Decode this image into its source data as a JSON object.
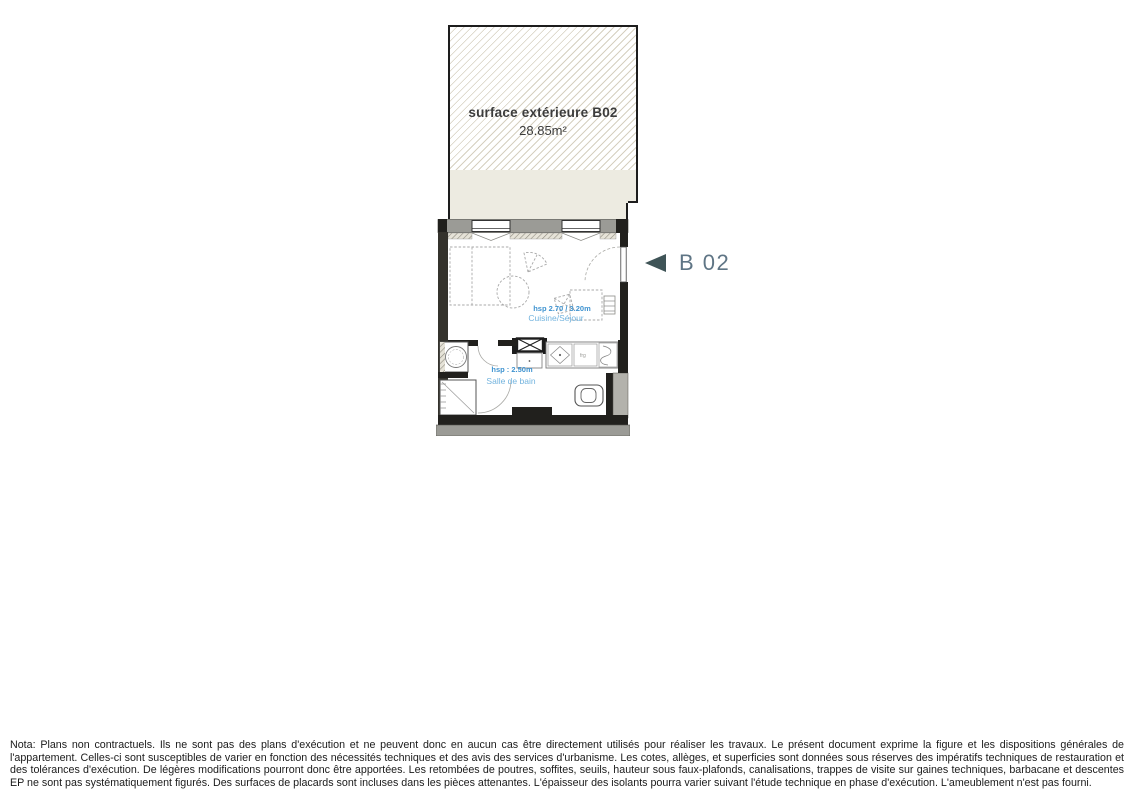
{
  "terrace": {
    "title": "surface extérieure B02",
    "area": "28.85m²"
  },
  "marker": {
    "label": "B 02"
  },
  "plan": {
    "rooms": [
      {
        "name": "Cuisine/Séjour",
        "ceiling_note": "hsp 2.70 / 3.20m"
      },
      {
        "name": "Salle de bain",
        "ceiling_note": "hsp : 2.50m"
      }
    ],
    "fridge_label": "frg"
  },
  "colors": {
    "room_label_blue": "#72b3de",
    "ceiling_note_blue": "#3f93d0",
    "marker_text": "#5f7585",
    "marker_arrow": "#3f5457",
    "terrace_floor_beige": "#edebe1",
    "hatch_line": "#d6d0c0",
    "wall_dark": "#21201d",
    "wall_gray": "#9b9b96"
  },
  "nota": {
    "text": "Nota: Plans non contractuels. Ils ne sont pas des plans d'exécution et ne peuvent donc en aucun cas être directement utilisés pour réaliser les travaux. Le présent document exprime la figure et les dispositions générales de l'appartement. Celles-ci sont susceptibles de varier en fonction des nécessités techniques et des avis des services d'urbanisme. Les cotes, allèges, et superficies sont données sous réserves des impératifs techniques de restauration et des tolérances d'exécution. De légères modifications pourront donc être apportées. Les retombées de poutres, soffites, seuils,  hauteur sous faux-plafonds, canalisations, trappes de visite sur gaines techniques, barbacane et descentes EP ne sont pas systématiquement figurés. Des surfaces de placards sont incluses dans les pièces attenantes. L'épaisseur des isolants pourra varier suivant l'étude technique en phase d'exécution. L'ameublement n'est pas fourni."
  }
}
